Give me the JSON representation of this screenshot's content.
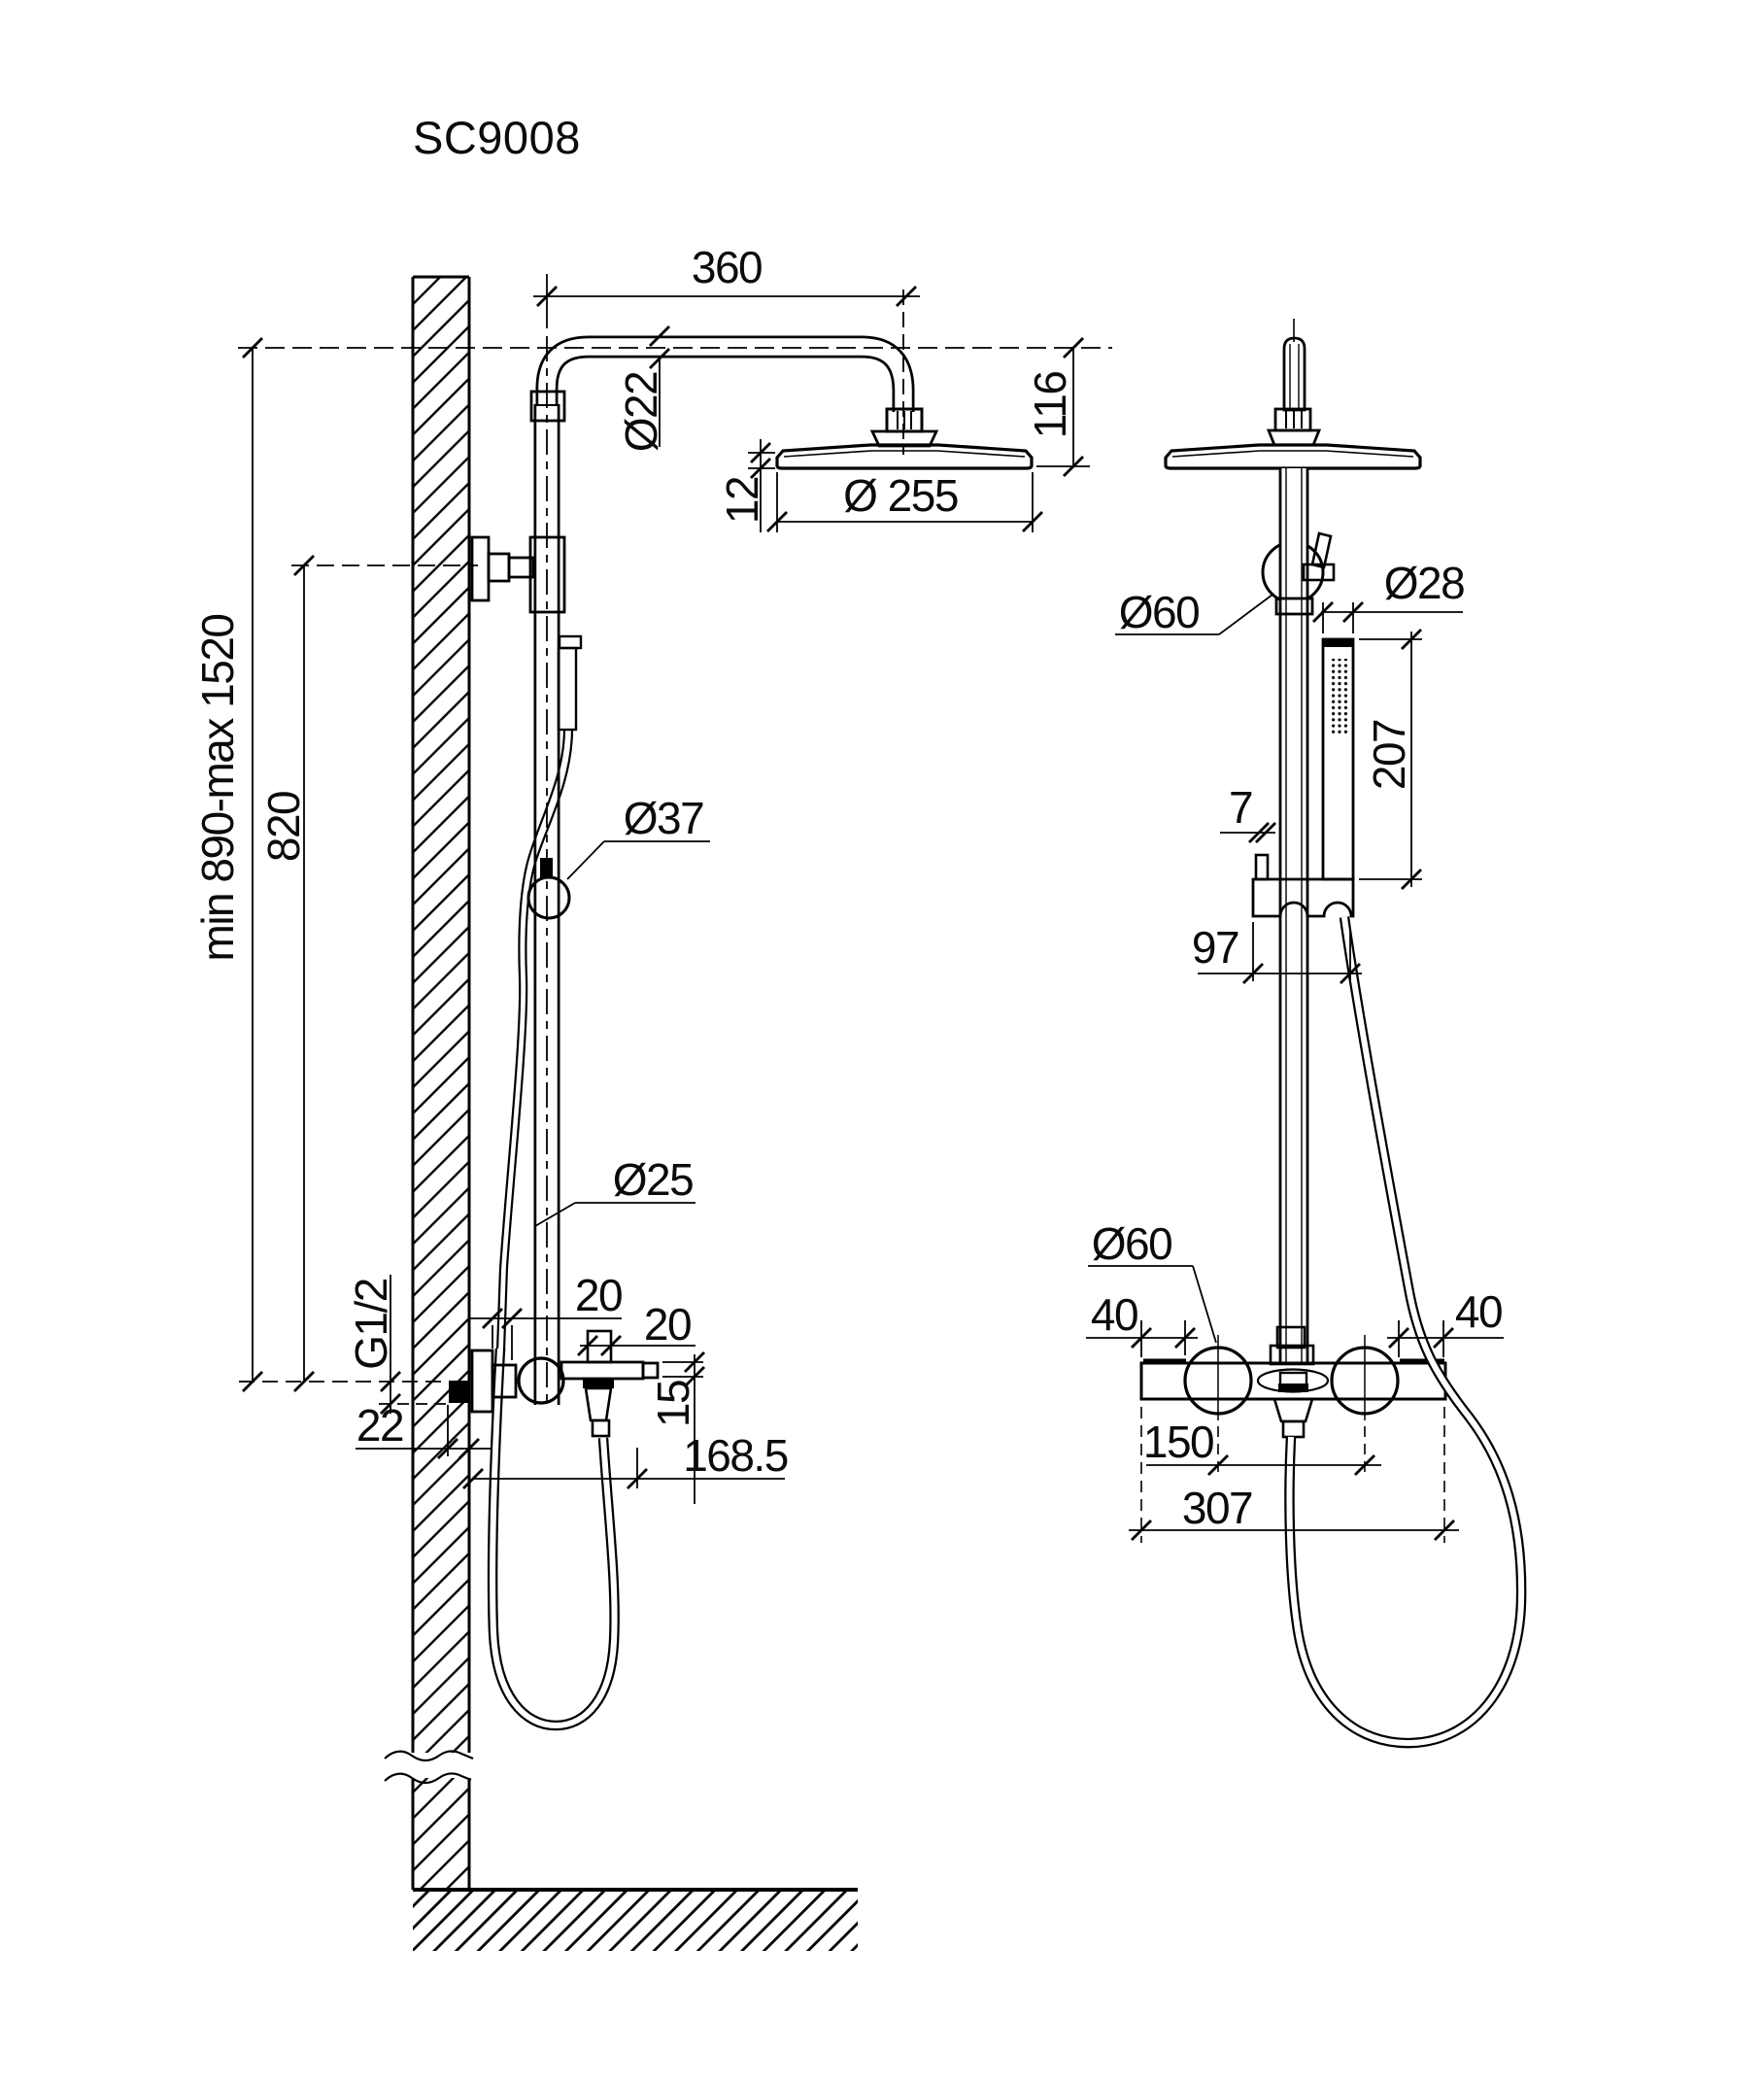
{
  "title": "SC9008",
  "colors": {
    "ink": "#000000",
    "paper": "#ffffff"
  },
  "left_view": {
    "dims": {
      "arm_length": "360",
      "arm_dia": "Ø22",
      "head_thickness": "12",
      "head_dia": "Ø 255",
      "head_drop": "116",
      "height_range": "min 890-max 1520",
      "bracket_height": "820",
      "slider_dia": "Ø37",
      "column_dia": "Ø25",
      "supply_thread": "G1/2",
      "supply_depth": "22",
      "escutcheon_offset": "20",
      "diverter_width": "20",
      "spout_height": "15",
      "outlet_reach": "168.5"
    }
  },
  "right_view": {
    "dims": {
      "swivel_dia": "Ø60",
      "wand_dia": "Ø28",
      "wand_length": "207",
      "holder_gap": "7",
      "holder_reach": "97",
      "knob_dia": "Ø60",
      "margin_left": "40",
      "margin_right": "40",
      "knob_spacing": "150",
      "body_width": "307"
    }
  }
}
